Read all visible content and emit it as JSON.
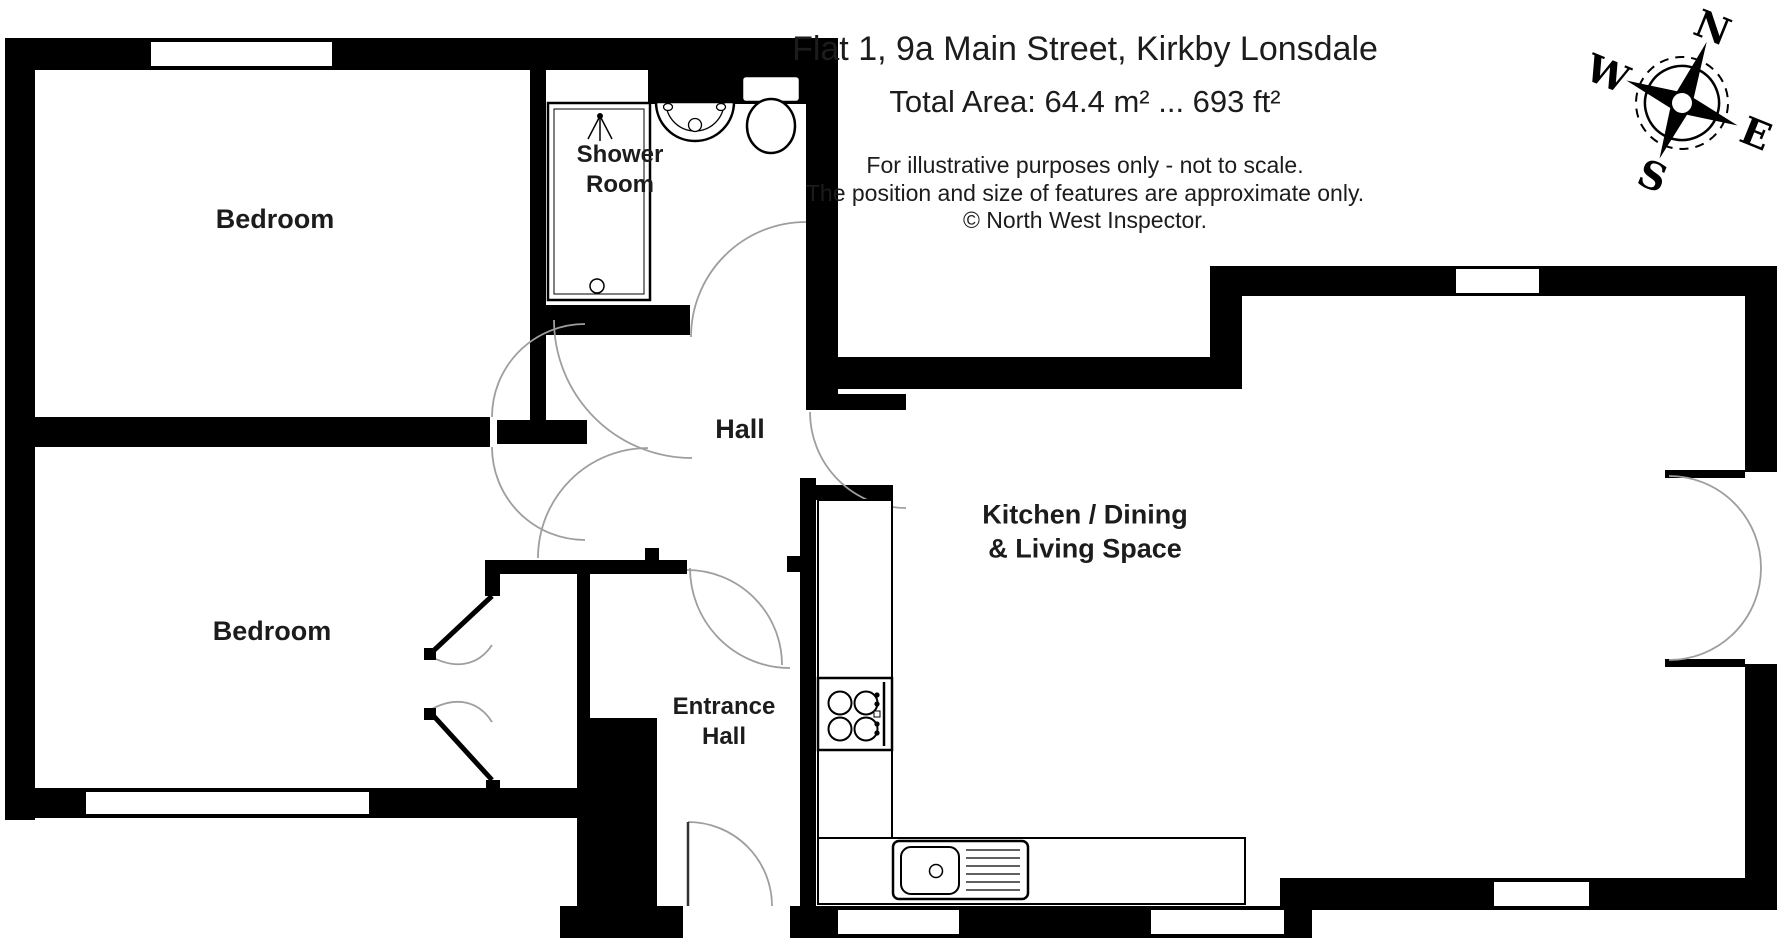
{
  "header": {
    "title": "Flat 1, 9a Main Street, Kirkby Lonsdale",
    "total_area": "Total Area: 64.4 m² ... 693 ft²",
    "note_line1": "For illustrative purposes only - not to scale.",
    "note_line2": "The position and size of features are approximate only.",
    "note_line3": "© North West Inspector."
  },
  "compass": {
    "north": "N",
    "south": "S",
    "east": "E",
    "west": "W",
    "rotation_deg": 22
  },
  "rooms": {
    "bedroom1": {
      "label": "Bedroom"
    },
    "bedroom2": {
      "label": "Bedroom"
    },
    "shower_room": {
      "label_line1": "Shower",
      "label_line2": "Room"
    },
    "hall": {
      "label": "Hall"
    },
    "entrance_hall": {
      "label_line1": "Entrance",
      "label_line2": "Hall"
    },
    "kitchen": {
      "label_line1": "Kitchen / Dining",
      "label_line2": "& Living Space"
    }
  },
  "colors": {
    "wall": "#000000",
    "text": "#1c1c1c",
    "door_arc": "#9e9e9e",
    "background": "#ffffff"
  }
}
